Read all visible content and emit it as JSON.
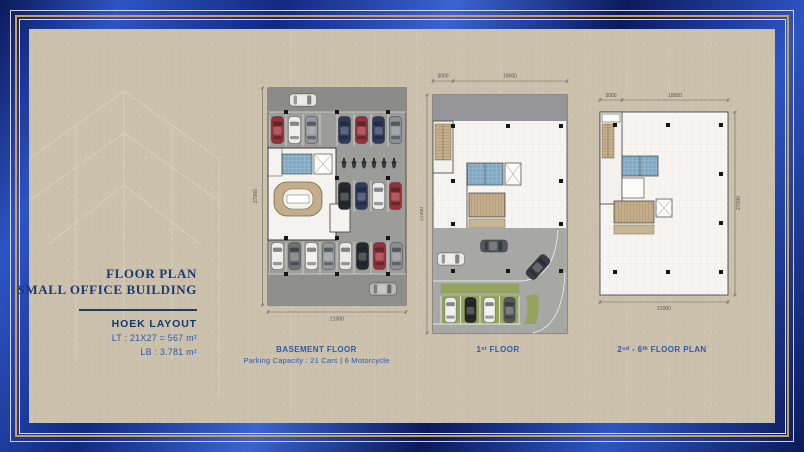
{
  "colors": {
    "frame_navy": "#0b1a5a",
    "frame_blue": "#2e54c4",
    "frame_blue_mid": "#12297f",
    "line_gold": "#c8a254",
    "line_cream": "#efe5c6",
    "canvas_beige": "#cbc0ac",
    "title_navy": "#1d3a70",
    "label_blue": "#2d5ca9"
  },
  "left_panel": {
    "title_line1": "FLOOR PLAN",
    "title_line2": "SMALL OFFICE BUILDING",
    "layout_title": "HOEK LAYOUT",
    "lt": "LT : 21X27 = 567 m²",
    "lb": "LB : 3.781 m²"
  },
  "plans": {
    "basement": {
      "label": "BASEMENT FLOOR",
      "sublabel": "Parking Capacity : 21 Cars | 6 Motorcycle",
      "dim_bottom": "21000",
      "dim_side": "27000"
    },
    "first": {
      "label": "1ˢᵗ FLOOR",
      "dim_top_left": "3000",
      "dim_top_right": "18000",
      "dim_side": "27000"
    },
    "upper": {
      "label": "2ⁿᵈ - 6ᵗʰ FLOOR PLAN",
      "dim_top_left": "3000",
      "dim_top_right": "18000",
      "dim_bottom": "21000",
      "dim_side": "27000"
    }
  }
}
